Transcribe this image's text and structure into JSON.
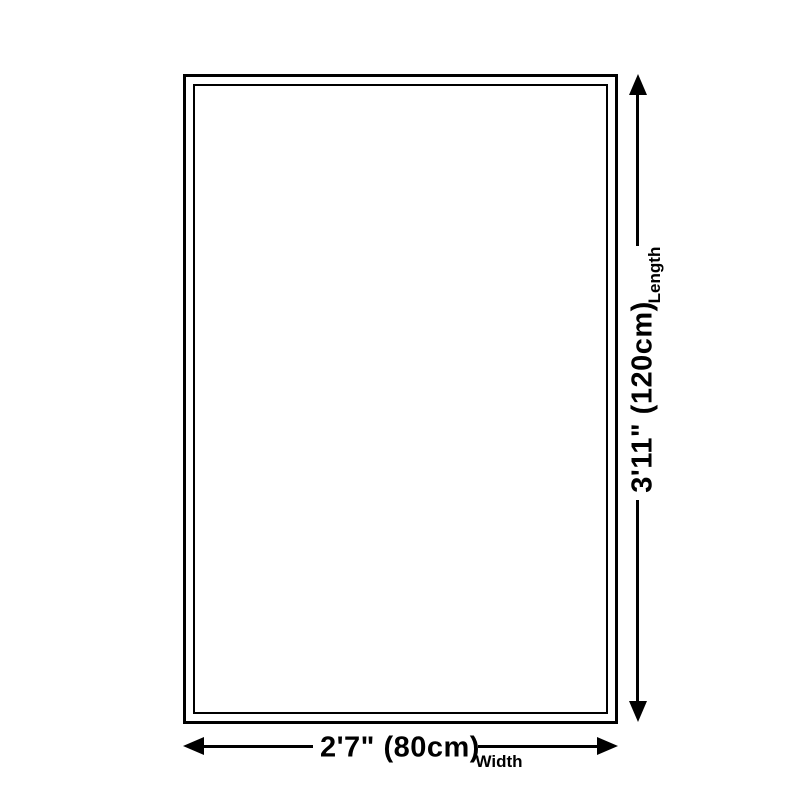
{
  "diagram": {
    "type": "product-dimension-diagram",
    "dimensions": {
      "length": {
        "value": "3'11\" (120cm)",
        "label": "Length",
        "feet_inches": "3'11\"",
        "metric": "120cm",
        "orientation": "vertical"
      },
      "width": {
        "value": "2'7\" (80cm)",
        "label": "Width",
        "feet_inches": "2'7\"",
        "metric": "80cm",
        "orientation": "horizontal"
      }
    },
    "colors": {
      "ink": "#000000",
      "background": "#ffffff"
    }
  }
}
